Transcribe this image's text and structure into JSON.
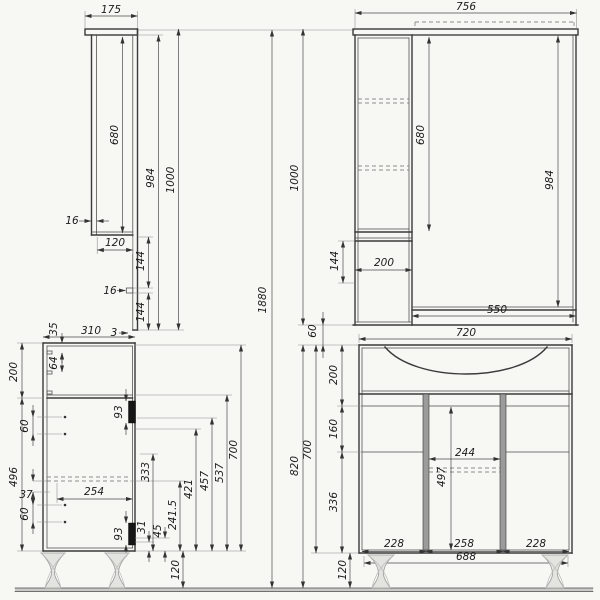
{
  "drawing": {
    "type": "furniture technical drawing",
    "views": [
      "mirror-cabinet side view",
      "mirror-cabinet front view",
      "vanity side view",
      "vanity front view"
    ]
  },
  "overall": {
    "total_height": "1880"
  },
  "ms": {
    "depth": "175",
    "door_thickness": "16",
    "door_height": "680",
    "body_height": "984",
    "total_height": "1000",
    "shelf_depth": "120",
    "shelf_gap_upper": "144",
    "shelf_thickness": "16",
    "shelf_gap_lower": "144",
    "bottom_gap": "3"
  },
  "mf": {
    "width": "756",
    "door_height": "680",
    "mirror_height": "984",
    "total_height": "1000",
    "shelf_gap": "144",
    "cabinet_width": "200",
    "mirror_width": "550",
    "gap_to_vanity": "60"
  },
  "vs": {
    "pin_offset": "35",
    "depth": "310",
    "pin_spacing": "64",
    "upper_section": "200",
    "pin_gap_upper": "60",
    "lower_section": "496",
    "pin_gap_small": "37",
    "pin_gap_lower": "60",
    "drawer_depth": "254",
    "hinge_upper": "93",
    "hinge_lower": "93",
    "h333": "333",
    "h421": "421",
    "h457": "457",
    "h537": "537",
    "h700": "700",
    "h241_5": "241.5",
    "h31": "31",
    "h45": "45",
    "leg_height": "120"
  },
  "vf": {
    "top_width": "720",
    "apron_height": "200",
    "mid_height": "160",
    "lower_height": "336",
    "body_height": "700",
    "total_height": "820",
    "inner_width": "244",
    "inner_height": "497",
    "door_left": "228",
    "door_mid": "258",
    "door_right": "228",
    "base_width": "688",
    "leg_height": "120"
  }
}
